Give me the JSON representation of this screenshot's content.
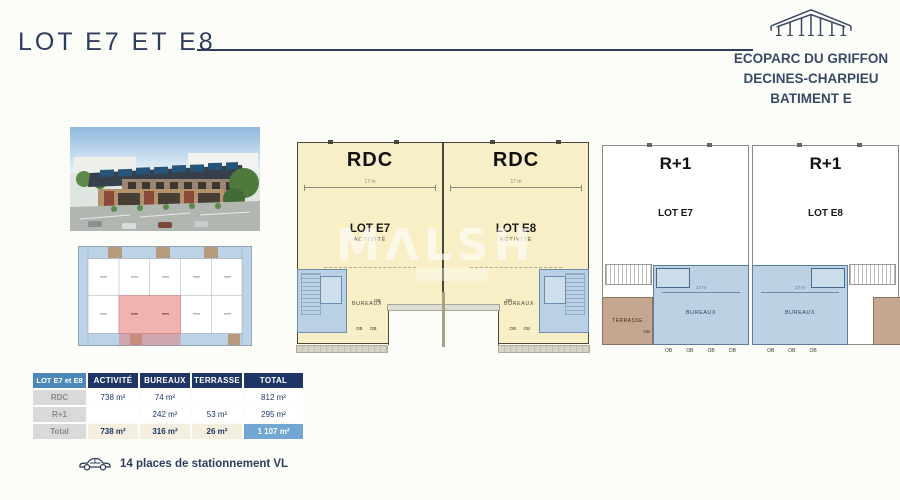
{
  "header": {
    "title": "LOT E7 ET E8",
    "brand": {
      "line1": "ECOPARC DU GRIFFON",
      "line2": "DECINES-CHARPIEU",
      "line3": "BATIMENT E"
    }
  },
  "watermark": "MΛLSH",
  "plans": {
    "ob": "OB",
    "dim": "17 m",
    "rdc": {
      "e7": {
        "floor": "RDC",
        "lot": "LOT E7",
        "zone": "ACTIVITÉ",
        "bureaux": "BUREAUX"
      },
      "e8": {
        "floor": "RDC",
        "lot": "LOT E8",
        "zone": "ACTIVITÉ",
        "bureaux": "BUREAUX"
      }
    },
    "r1": {
      "e7": {
        "floor": "R+1",
        "lot": "LOT E7",
        "bureaux": "BUREAUX",
        "terrasse": "TERRASSE"
      },
      "e8": {
        "floor": "R+1",
        "lot": "LOT E8",
        "bureaux": "BUREAUX"
      }
    }
  },
  "table": {
    "corner": "LOT E7 et E8",
    "columns": [
      "ACTIVITÉ",
      "BUREAUX",
      "TERRASSE",
      "TOTAL"
    ],
    "rows": [
      {
        "label": "RDC",
        "values": [
          "738 m²",
          "74 m²",
          "",
          "812 m²"
        ]
      },
      {
        "label": "R+1",
        "values": [
          "",
          "242 m²",
          "53 m²",
          "295 m²"
        ]
      },
      {
        "label": "Total",
        "values": [
          "738 m²",
          "316 m²",
          "26 m²",
          "1 107 m²"
        ]
      }
    ]
  },
  "parking": {
    "label": "14 places de stationnement VL"
  },
  "colors": {
    "navy": "#2e3d5c",
    "table_navy": "#1e3565",
    "table_blue": "#4c87ba",
    "total_blue": "#72a7d4",
    "plan_yellow": "#f8efc6",
    "plan_blue": "#bad0e4",
    "terrasse_tan": "#c5a78f",
    "highlight_red": "#f1b2b2"
  }
}
